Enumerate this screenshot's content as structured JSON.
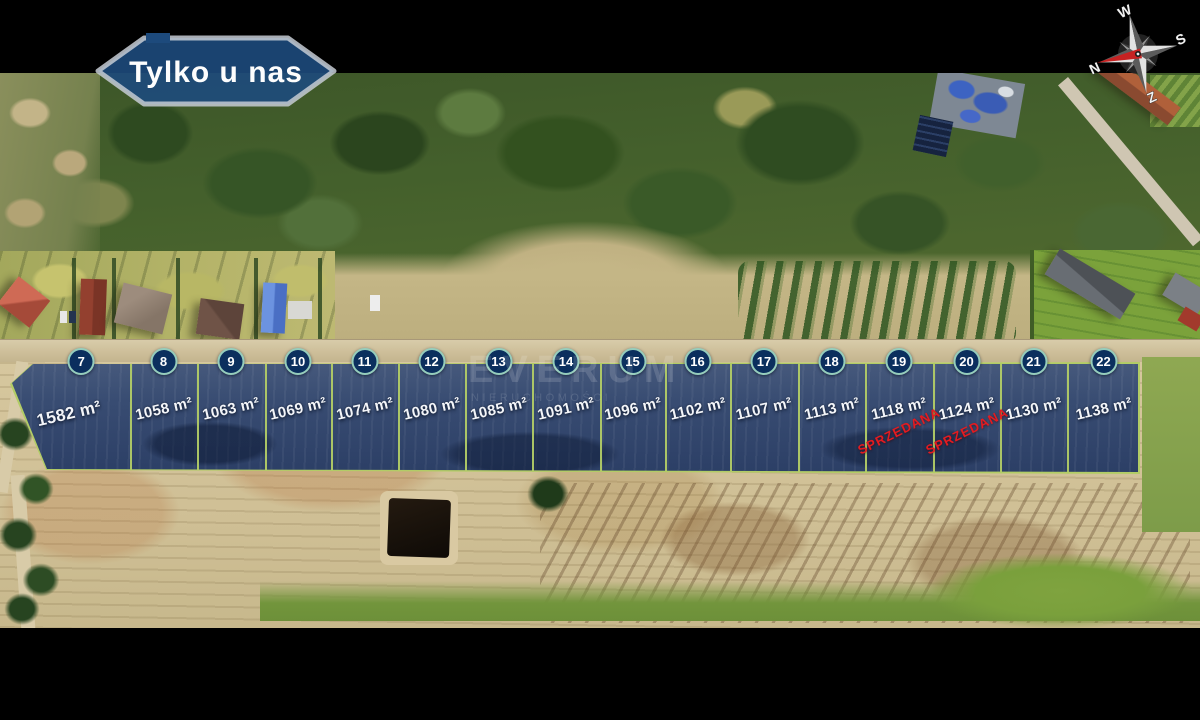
{
  "badge": {
    "label": "Tylko u nas"
  },
  "compass": {
    "north": "N",
    "south": "S",
    "east": "W",
    "west": "Z"
  },
  "watermark": {
    "brand": "EVERUM",
    "sub": "NIERUCHOMOŚCI"
  },
  "colors": {
    "plot_border": "#b2cc66",
    "plot_fill_navy": "#33476e",
    "badge_navy": "#0b2f5e",
    "sold_red": "#e41b20",
    "sign_navy": "#1d4a7c"
  },
  "plots": [
    {
      "number": "7",
      "area": "1582 m²"
    },
    {
      "number": "8",
      "area": "1058 m²"
    },
    {
      "number": "9",
      "area": "1063 m²"
    },
    {
      "number": "10",
      "area": "1069 m²"
    },
    {
      "number": "11",
      "area": "1074 m²"
    },
    {
      "number": "12",
      "area": "1080 m²"
    },
    {
      "number": "13",
      "area": "1085 m²"
    },
    {
      "number": "14",
      "area": "1091 m²"
    },
    {
      "number": "15",
      "area": "1096 m²"
    },
    {
      "number": "16",
      "area": "1102 m²"
    },
    {
      "number": "17",
      "area": "1107 m²"
    },
    {
      "number": "18",
      "area": "1113 m²"
    },
    {
      "number": "19",
      "area": "1118 m²",
      "sold_label": "SPRZEDANA"
    },
    {
      "number": "20",
      "area": "1124 m²",
      "sold_label": "SPRZEDANA"
    },
    {
      "number": "21",
      "area": "1130 m²"
    },
    {
      "number": "22",
      "area": "1138 m²"
    }
  ]
}
